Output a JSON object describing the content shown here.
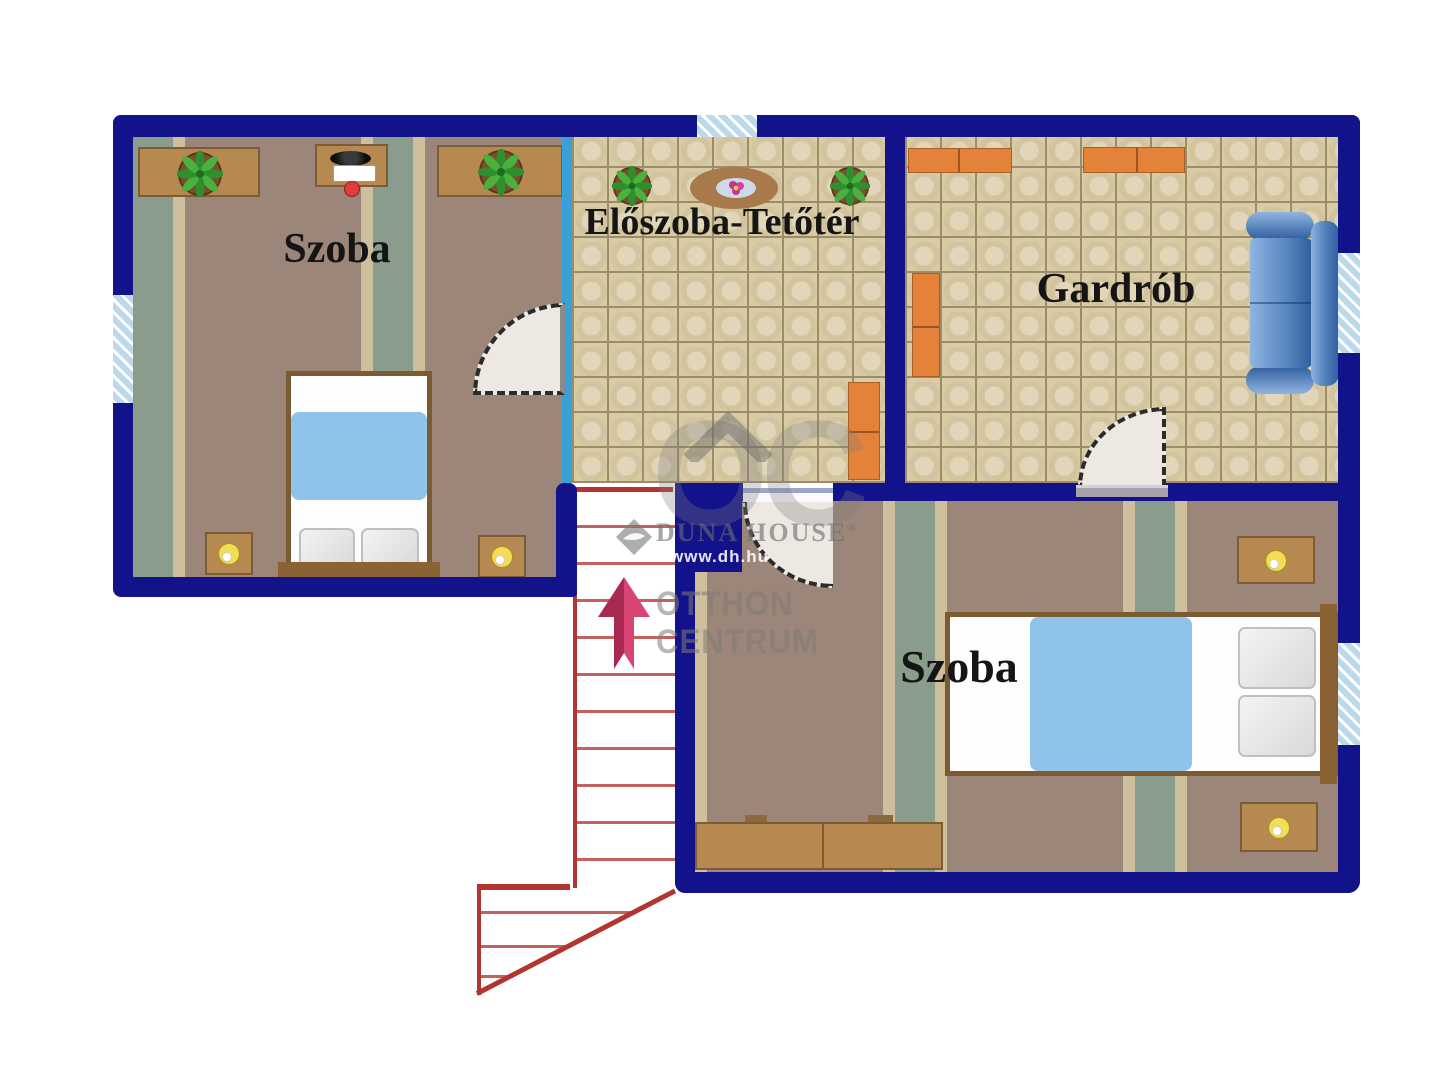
{
  "rooms": {
    "room_top_left": {
      "label": "Szoba"
    },
    "hallway": {
      "label": "Előszoba-Tetőtér"
    },
    "wardrobe": {
      "label": "Gardrób"
    },
    "room_bottom_right": {
      "label": "Szoba"
    }
  },
  "watermark": {
    "monogram": "OC",
    "brand": "DUNA HOUSE",
    "registered": "®",
    "website": "www.dh.hu",
    "org_line1": "OTTHON",
    "org_line2": "CENTRUM"
  },
  "colors": {
    "wall": "#12128A",
    "glass": "#3AA0D8",
    "window_fill": "#BCD9EC",
    "stair": "#B23530",
    "arrow_dark": "#A82A50",
    "arrow_light": "#D94572",
    "floor_brown": "#9C8579",
    "stripe_sage": "#8A9C8B",
    "stripe_cream": "#CDBF9C",
    "tile_base": "#D8CBA5",
    "tile_grout": "#9A8D68",
    "wood": "#B5894F",
    "wood_edge": "#7C5C36",
    "orange": "#E5823A",
    "sofa_dark": "#2F5D9E",
    "sofa_mid": "#5B8AC4",
    "sofa_light": "#8FB4E0",
    "blanket": "#90C3EA",
    "ink": "#151515",
    "wm": "#7D7D7D",
    "door_fill": "#EDE8E2"
  }
}
